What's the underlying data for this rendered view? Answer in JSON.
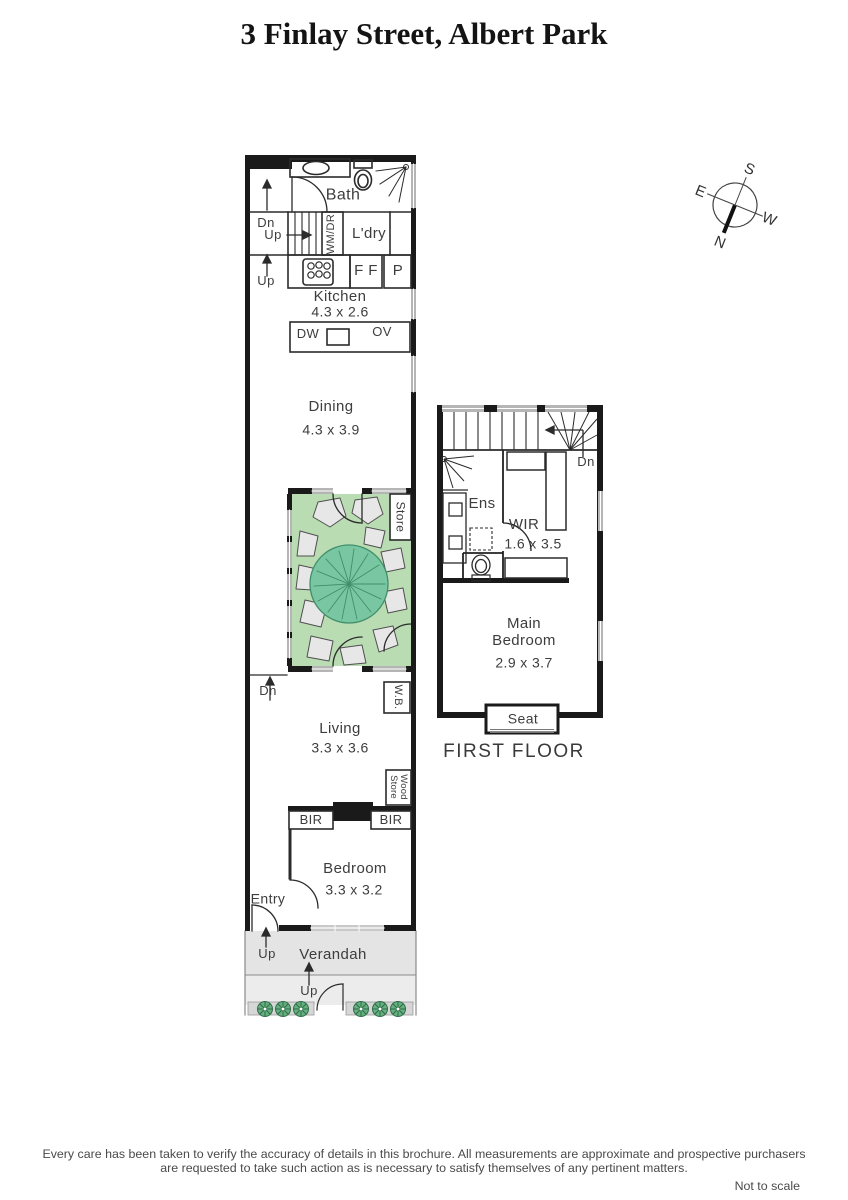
{
  "title": "3 Finlay Street, Albert Park",
  "compass": {
    "n": "N",
    "s": "S",
    "e": "E",
    "w": "W"
  },
  "gf": {
    "bath": "Bath",
    "dn_upper": "Dn",
    "up_stairs": "Up",
    "wm_dr": "WM/DR",
    "ldry": "L'dry",
    "ff": "F F",
    "p": "P",
    "up_kitchen": "Up",
    "kitchen": "Kitchen",
    "kitchen_dim": "4.3 x 2.6",
    "dw": "DW",
    "ov": "OV",
    "dining": "Dining",
    "dining_dim": "4.3 x 3.9",
    "store": "Store",
    "dn_living": "Dn",
    "wb": "W.B.",
    "living": "Living",
    "living_dim": "3.3 x 3.6",
    "wood_store": "Wood\nStore",
    "bir_left": "BIR",
    "bir_right": "BIR",
    "bedroom": "Bedroom",
    "bedroom_dim": "3.3 x 3.2",
    "entry": "Entry",
    "up_verandah": "Up",
    "verandah": "Verandah",
    "up_path": "Up"
  },
  "ff": {
    "dn": "Dn",
    "ens": "Ens",
    "wir": "WIR",
    "wir_dim": "1.6 x 3.5",
    "main_line1": "Main",
    "main_line2": "Bedroom",
    "main_dim": "2.9 x 3.7",
    "seat": "Seat",
    "label": "FIRST FLOOR"
  },
  "footer": {
    "disclaimer_line1": "Every care has been taken to verify the accuracy of details in this brochure.  All measurements are approximate and prospective purchasers",
    "disclaimer_line2": "are requested to take such action as is necessary to satisfy themselves of any pertinent matters.",
    "scale_note": "Not to scale"
  },
  "colors": {
    "wall_black": "#1a1a1a",
    "line_grey": "#2b2b2b",
    "window_grey": "#b5b5b5",
    "courtyard_green": "#b9dcb2",
    "tree_green": "#79c7a2",
    "tree_line": "#418f6a",
    "stone_grey": "#e7e7e7",
    "verandah_grey": "#e4e4e4",
    "shrub_green": "#66b07f"
  }
}
